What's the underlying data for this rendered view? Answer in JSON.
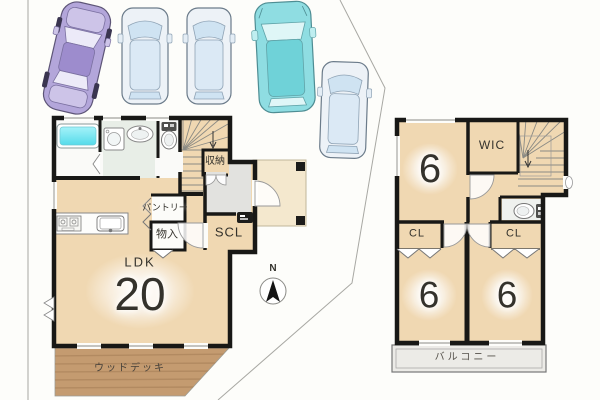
{
  "title": "2-story house floor plan with parking",
  "colors": {
    "floor_tan": "#f0d8b2",
    "room_glow": "#fffdf6",
    "deck_brown": "#c49b70",
    "balcony_grey": "#ecebe7",
    "bath_cyan": "#7ce4f0",
    "washroom_green": "#e8eee7",
    "entry_tile_grey": "#e2e2df",
    "porch_tan": "#f2e3c4",
    "wall_black": "#181816",
    "boundary_grey": "#a8a8a3",
    "car_purple": "#b3a6da",
    "car_blue_body": "#edf2f7",
    "car_blue_glass": "#cfe3f2",
    "car_teal": "#8fdde2"
  },
  "floor1": {
    "labels": {
      "ldk_label": "LDK",
      "ldk_size": "20",
      "pantry": "パントリー",
      "monoire": "物入",
      "scl": "SCL",
      "shuno": "収納",
      "deck": "ウッドデッキ"
    }
  },
  "floor2": {
    "labels": {
      "room_top": "6",
      "wic": "WIC",
      "cl_left": "CL",
      "cl_right": "CL",
      "room_bl": "6",
      "room_br": "6",
      "balcony": "バルコニー"
    }
  },
  "compass": {
    "north": "N"
  },
  "parking": {
    "car_count": "5"
  }
}
